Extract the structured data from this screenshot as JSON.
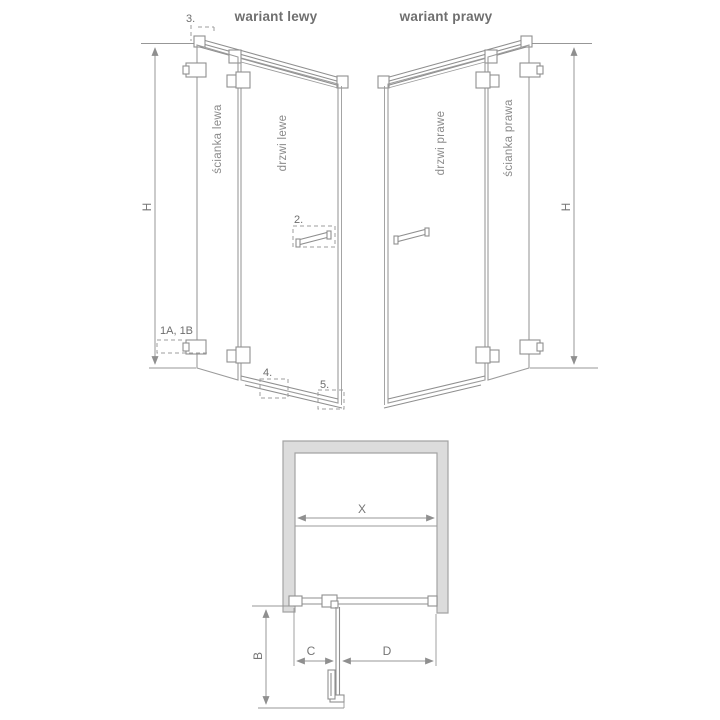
{
  "colors": {
    "line": "#9b9b9b",
    "profile": "#8f8f8f",
    "dim": "#979797",
    "dashed": "#9e9e9e",
    "text": "#757575",
    "label": "#8a8a8a",
    "header_text": "#6f6f6f",
    "wall_fill": "#dcdcdc",
    "wall_stroke": "#a3a3a3"
  },
  "headers": {
    "left": "wariant lewy",
    "right": "wariant prawy"
  },
  "left_variant": {
    "wall_label": "ścianka lewa",
    "door_label": "drzwi lewe",
    "height_dim": "H",
    "callout_top_profile": "3.",
    "callout_handle": "2.",
    "callout_hinges": "1A, 1B",
    "callout_bottom_seal": "4.",
    "callout_bottom_corner": "5."
  },
  "right_variant": {
    "door_label": "drzwi prawe",
    "wall_label": "ścianka prawa",
    "height_dim": "H"
  },
  "plan_view": {
    "width_dim": "X",
    "depth_dim": "B",
    "panel_dim": "C",
    "door_dim": "D"
  }
}
